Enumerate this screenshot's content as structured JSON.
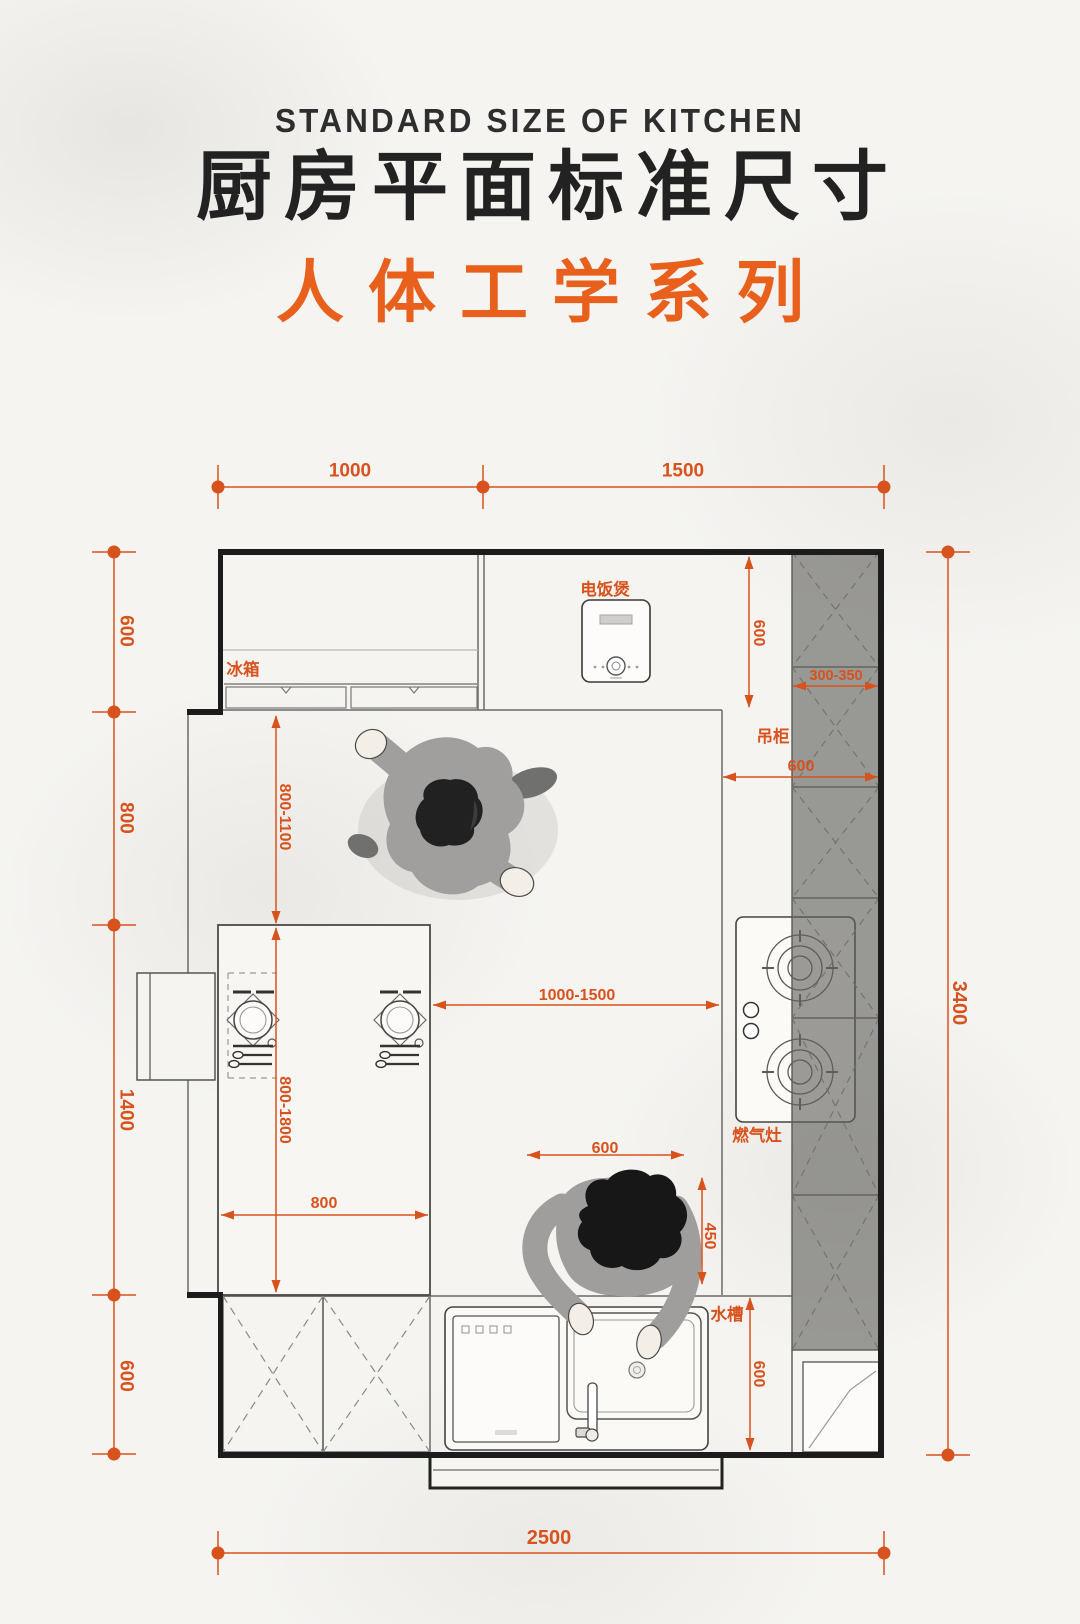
{
  "page": {
    "background": "#f5f4f1",
    "accent_orange": "#d8521e",
    "title_black": "#222222",
    "wall_black": "#1c1c1c",
    "cabinet_gray": "#989896"
  },
  "header": {
    "title_en": "STANDARD SIZE OF KITCHEN",
    "title_zh": "厨房平面标准尺寸",
    "subtitle": "人体工学系列"
  },
  "plan": {
    "labels": {
      "rice_cooker": "电饭煲",
      "fridge": "冰箱",
      "wall_cabinet": "吊柜",
      "gas_stove": "燃气灶",
      "sink": "水槽"
    },
    "dimensions": {
      "top": [
        "1000",
        "1500"
      ],
      "left": [
        "600",
        "800",
        "1400",
        "600"
      ],
      "right_total": "3400",
      "bottom_total": "2500",
      "counter_depth_top": "600",
      "wall_cabinet_depth": "300-350",
      "right_counter_depth": "600",
      "walkway_fridge": "800-1100",
      "island_length": "800-1800",
      "island_width": "800",
      "walkway_island": "1000-1500",
      "sink_zone_width": "600",
      "sink_reach": "450",
      "bottom_counter_depth": "600"
    }
  }
}
